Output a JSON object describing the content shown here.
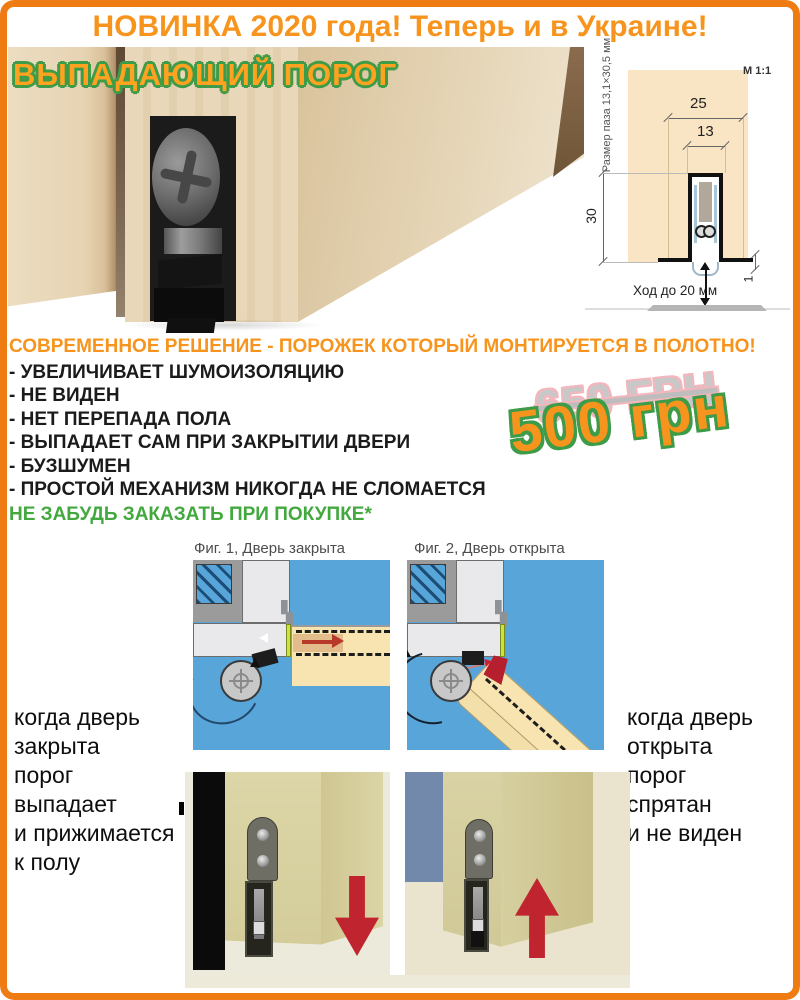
{
  "colors": {
    "accent_orange": "#f7941d",
    "border_orange": "#ee7c12",
    "outline_green": "#3e9b47",
    "note_green": "#43a93f",
    "old_price_gray": "#c8c8c8",
    "old_price_outline_pink": "#f3b6bd",
    "figure_blue": "#57a5d9",
    "arrow_red": "#c0242e"
  },
  "banner": {
    "text": "НОВИНКА 2020 года! Теперь и в Украине!"
  },
  "product": {
    "title": "ВЫПАДАЮЩИЙ ПОРОГ"
  },
  "tech_diagram": {
    "scale": "М 1:1",
    "groove_size_label": "Размер паза 13,1×30,5 мм",
    "dim_outer_width_mm": "25",
    "dim_inner_width_mm": "13",
    "dim_depth_mm": "30",
    "dim_gap_mm": "1",
    "travel_label": "Ход до 20 мм"
  },
  "headline": "СОВРЕМЕННОЕ РЕШЕНИЕ - ПОРОЖЕК КОТОРЫЙ МОНТИРУЕТСЯ В ПОЛОТНО!",
  "features": [
    "- УВЕЛИЧИВАЕТ ШУМОИЗОЛЯЦИЮ",
    "- НЕ ВИДЕН",
    "- НЕТ ПЕРЕПАДА ПОЛА",
    "- ВЫПАДАЕТ САМ ПРИ ЗАКРЫТИИ ДВЕРИ",
    "- БУЗШУМЕН",
    "- ПРОСТОЙ МЕХАНИЗМ НИКОГДА НЕ СЛОМАЕТСЯ"
  ],
  "order_note": "НЕ ЗАБУДЬ ЗАКАЗАТЬ ПРИ ПОКУПКЕ*",
  "price": {
    "old": "650 ГРН",
    "new": "500 грн"
  },
  "figures": {
    "fig1_caption": "Фиг. 1, Дверь закрыта",
    "fig2_caption": "Фиг. 2, Дверь открыта"
  },
  "closed_note": {
    "lines": [
      "когда дверь",
      "закрыта",
      "порог",
      "выпадает",
      "и прижимается",
      "к полу"
    ]
  },
  "open_note": {
    "lines": [
      "когда дверь",
      "открыта",
      "порог",
      "спрятан",
      "и не виден"
    ]
  }
}
